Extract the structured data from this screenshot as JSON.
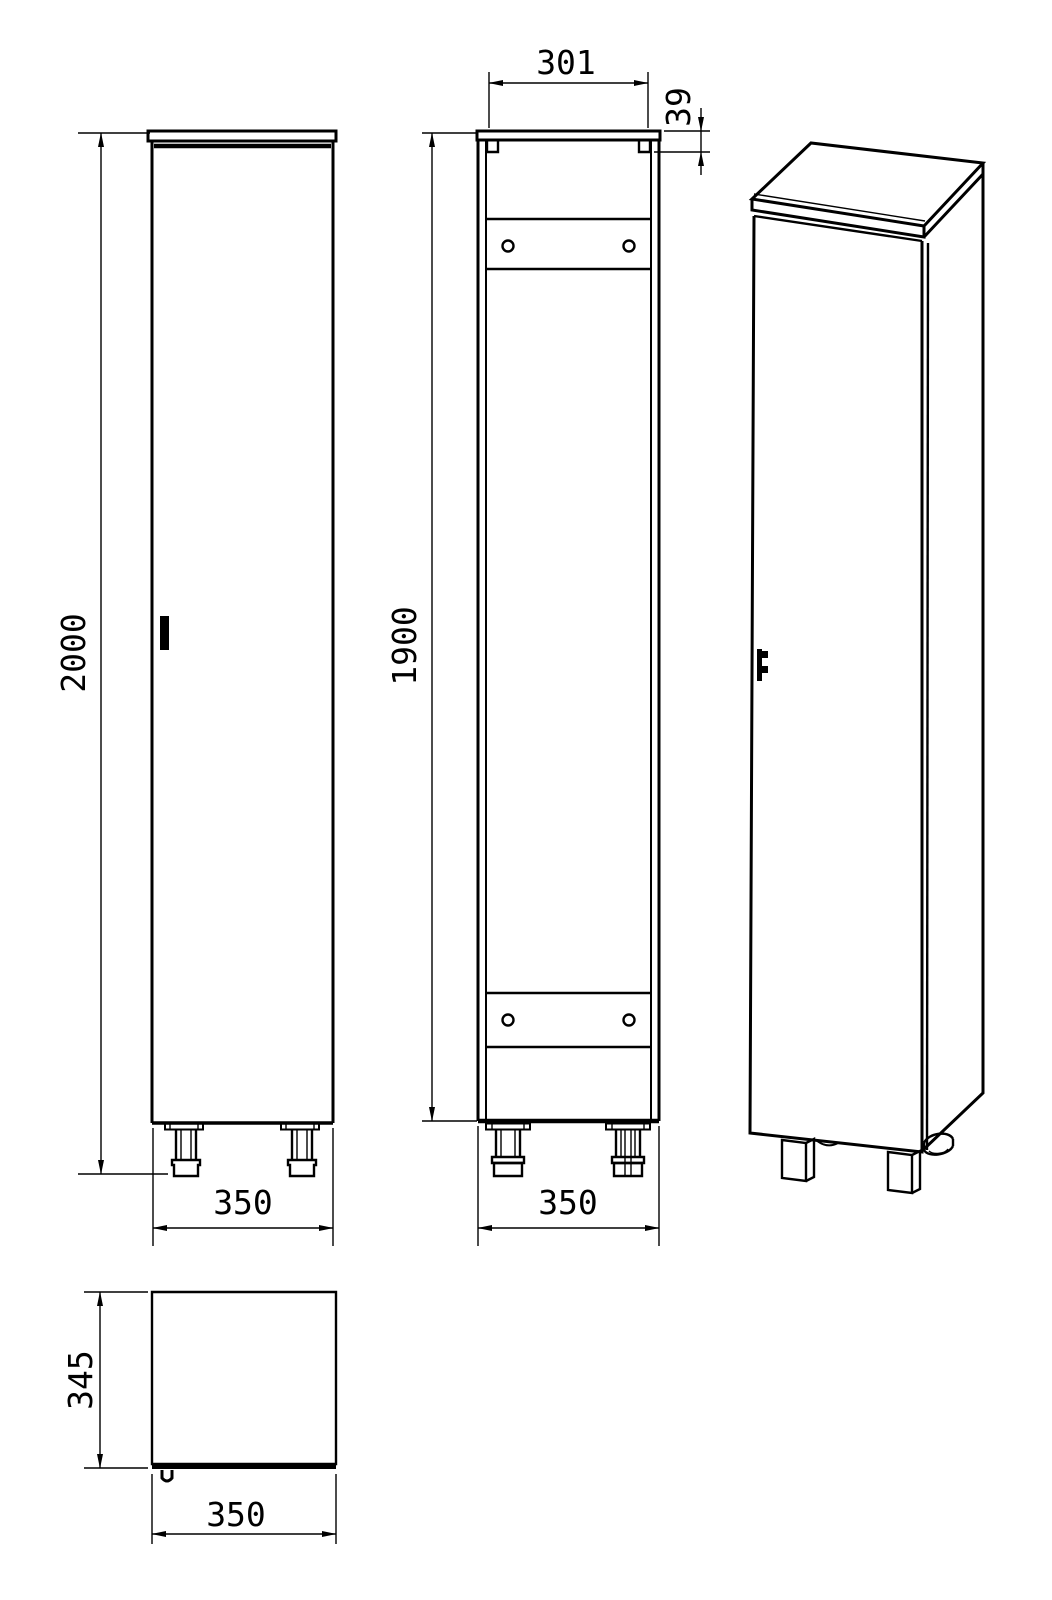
{
  "drawing": {
    "type": "furniture-technical-drawing",
    "subject": "tall single-door cabinet, four views (front, back, isometric, top)",
    "line_color": "#000000",
    "background_color": "#ffffff",
    "dims": {
      "front": {
        "height": "2000",
        "width": "350"
      },
      "back": {
        "top_inner_width": "301",
        "top_notch_depth": "39",
        "height": "1900",
        "width": "350"
      },
      "top": {
        "depth": "345",
        "width": "350"
      }
    }
  }
}
